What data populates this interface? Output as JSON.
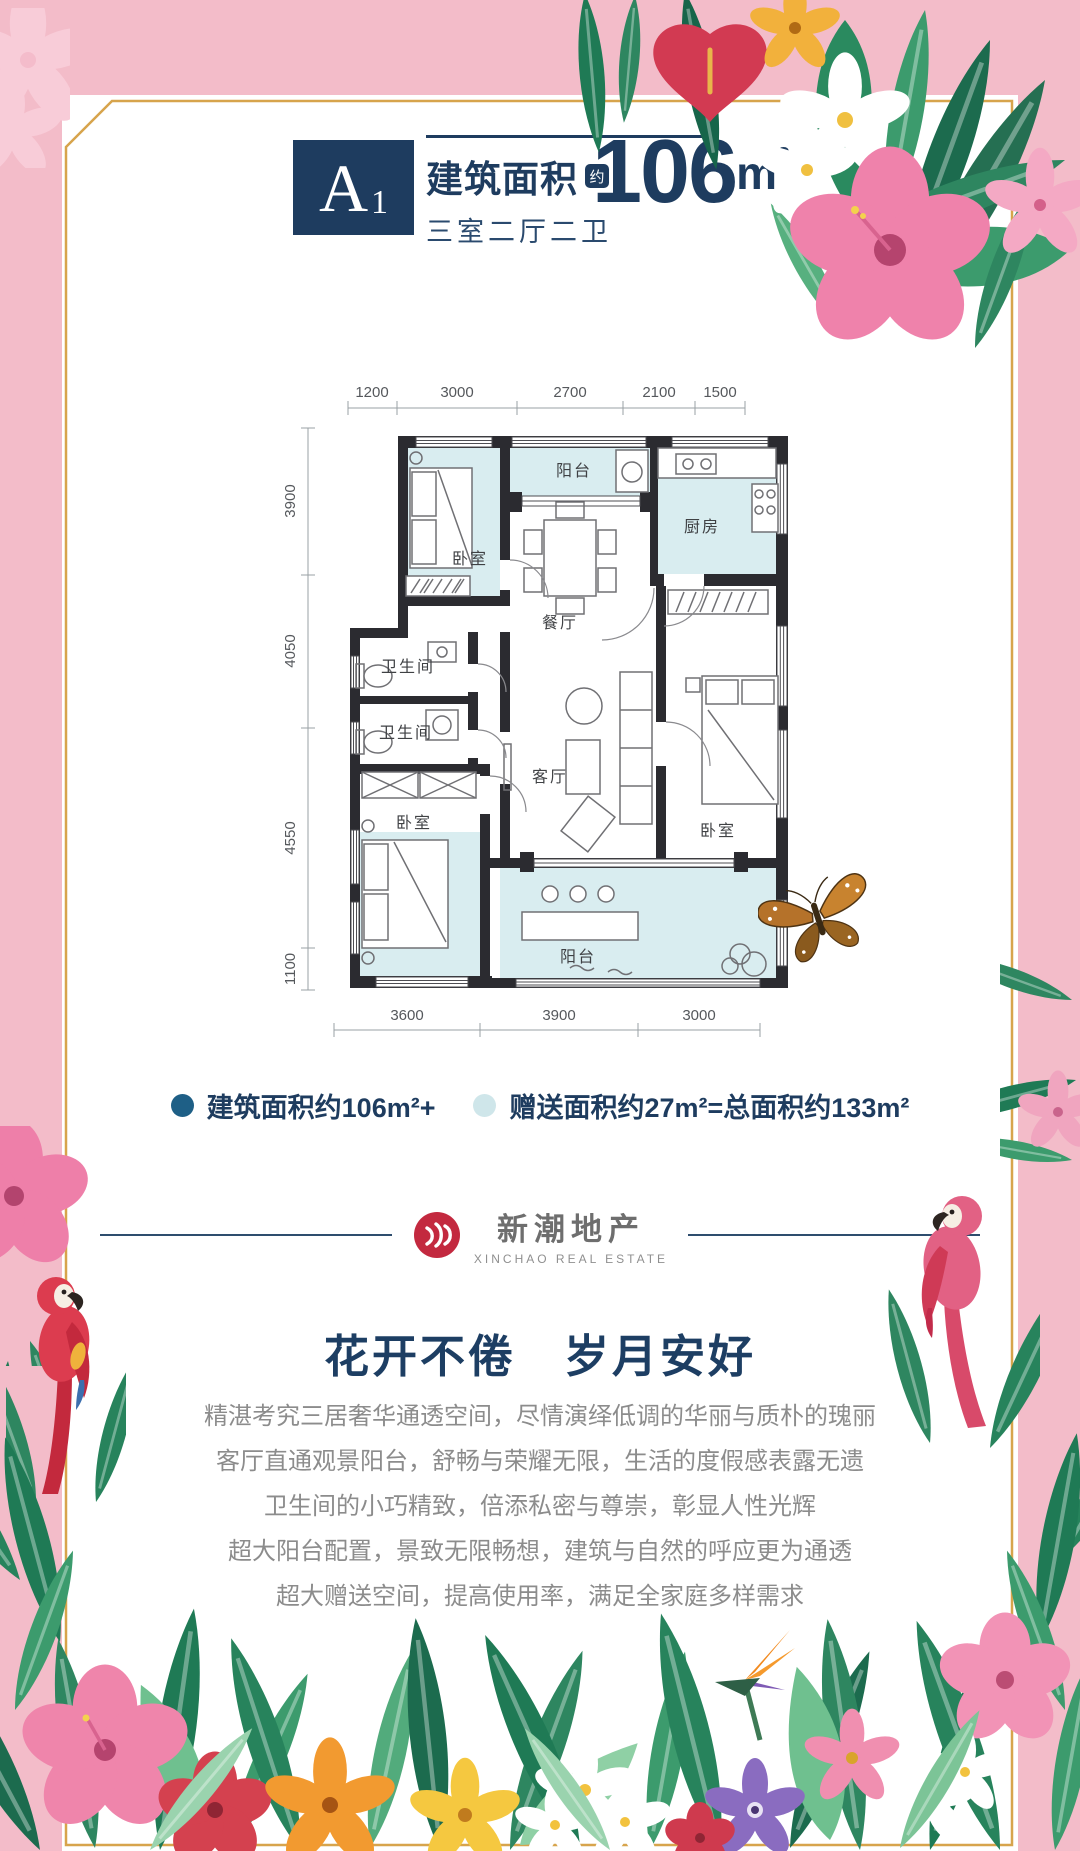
{
  "colors": {
    "frame_pink": "#f3bcc9",
    "gold_border": "#d7a44c",
    "navy": "#1e3c5f",
    "room_fill": "#d9edf0",
    "legend_dark_dot": "#1e5f86",
    "legend_light_dot": "#cfe6ea",
    "logo_red": "#c3293f"
  },
  "header": {
    "unit": "A",
    "unit_sub": "1",
    "area_label": "建筑面积",
    "approx_badge": "约",
    "layout_label": "三室二厅二卫",
    "area_value": "106",
    "area_unit": "m",
    "area_unit_sup": "2"
  },
  "floorplan": {
    "dims_top": [
      "1200",
      "3000",
      "2700",
      "2100",
      "1500"
    ],
    "dims_left": [
      "3900",
      "4050",
      "4550",
      "1100"
    ],
    "dims_bottom": [
      "3600",
      "3900",
      "3000"
    ],
    "rooms": {
      "bedroom_top": "卧室",
      "balcony_top": "阳台",
      "kitchen": "厨房",
      "dining": "餐厅",
      "bath1": "卫生间",
      "bath2": "卫生间",
      "living": "客厅",
      "bedroom_right": "卧室",
      "bedroom_left": "卧室",
      "balcony_bottom": "阳台"
    }
  },
  "legend": {
    "item1": "建筑面积约106m²+",
    "item2": "赠送面积约27m²=总面积约133m²"
  },
  "logo": {
    "cn": "新潮地产",
    "en": "XINCHAO REAL ESTATE"
  },
  "slogan": "花开不倦　岁月安好",
  "description": [
    "精湛考究三居奢华通透空间，尽情演绎低调的华丽与质朴的瑰丽",
    "客厅直通观景阳台，舒畅与荣耀无限，生活的度假感表露无遗",
    "卫生间的小巧精致，倍添私密与尊崇，彰显人性光辉",
    "超大阳台配置，景致无限畅想，建筑与自然的呼应更为通透",
    "超大赠送空间，提高使用率，满足全家庭多样需求"
  ]
}
